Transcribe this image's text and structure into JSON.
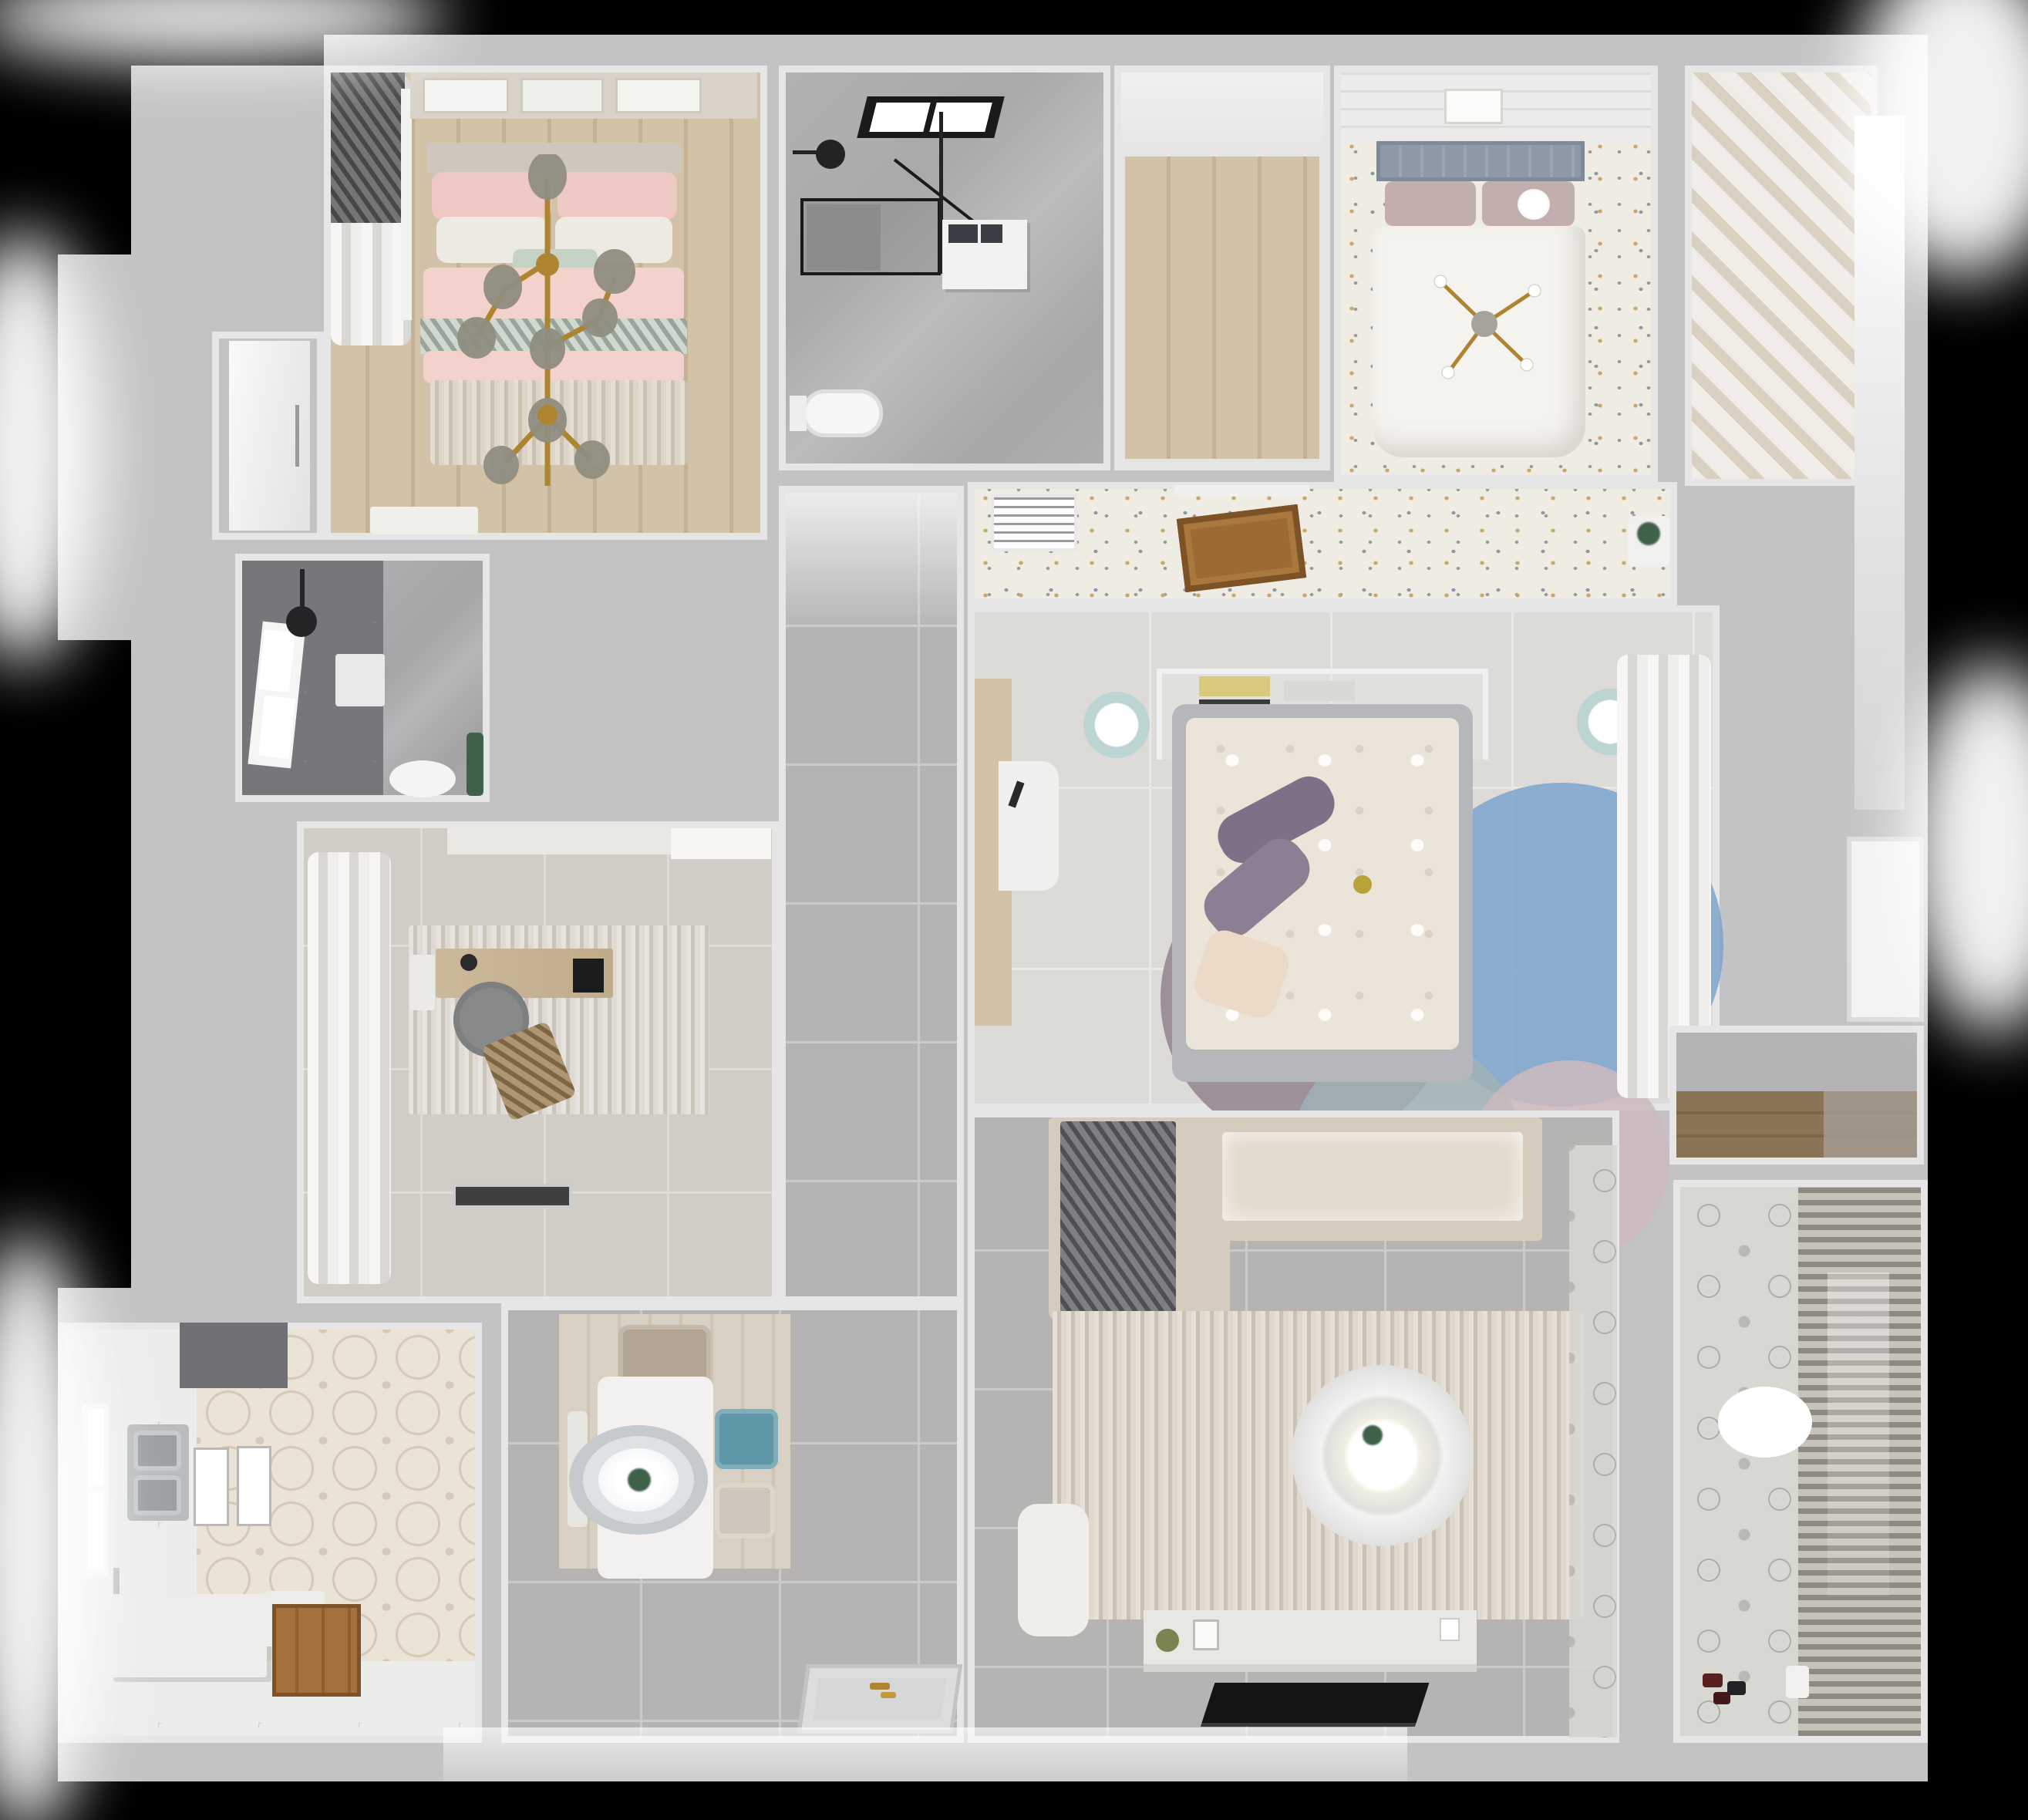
{
  "scene": {
    "type": "3d-floor-plan-top-down-render",
    "style": "photorealistic dollhouse view of an apartment",
    "background": "black with soft white light glows around the outer walls",
    "no_visible_text": true
  },
  "palette": {
    "bg": "#000000",
    "wall": "#c3c3c5",
    "wallface": "#e6e6e7",
    "tile": "#b5b4b2",
    "grout": "#cbcac8",
    "tile_light": "#d0cdc7",
    "grout_light": "#dfdcd6",
    "tile_large": "#dcdbd7",
    "grout_large": "#e9e8e4",
    "marble": "#adadaf",
    "dark_tile": "#75777a",
    "marble2": "#b6b8b9",
    "wood_a": "#d2c3a8",
    "wood_b": "#c5b294",
    "wood_door": "#9c6b33",
    "wood_dark": "#8a7456",
    "speckle_base": "#efece3",
    "speck1": "#c9a96a",
    "speck2": "#8a97a6",
    "speck3": "#9a9a94",
    "pink": "#f2d2cb",
    "pink_deep": "#eec8c3",
    "sage": "#c7d2c7",
    "white_soft": "#edeae4",
    "headboard_blue": "#8e99a8",
    "mauve": "#c3aeae",
    "duvet_white": "#f5f3ee",
    "cream": "#ebe5d9",
    "purple": "#7c7186",
    "bedframe": "#b5b7ba",
    "cream_pillow": "#ecd9c8",
    "rug_blue": "#7ba3cd",
    "rug_mauve": "#8f7d88",
    "rug_teal": "#9fb2b6",
    "rug_pink": "#cdb9bd",
    "rug_beige": "#d8cfc1",
    "sofa": "#d5ccbd",
    "cushion": "#e2dacb",
    "blanket": "#65676a",
    "table_white": "#f2f1ef",
    "teal": "#5e98a8",
    "chair_beige": "#b3a593",
    "chair_light": "#cfc6bb",
    "hex_base": "#eae3d6",
    "hex_line": "#d6c9b6",
    "white_tile": "#ececea",
    "steel": "#9aa0a3",
    "counter": "#ededeb",
    "dark_appliance": "#6f7174",
    "balc_tile": "#d8d8d3",
    "blind_a": "#8e8a82",
    "blind_b": "#c7c3bb",
    "gold": "#ad8530",
    "black": "#1a1a1c",
    "green": "#3f6049",
    "curtain_a": "#f7f6f4",
    "curtain_b": "#d9d8d5",
    "slat_a": "#f0ede8",
    "slat_b": "#d9d0c1",
    "console": "#e9e7e3",
    "glassdark": "#8a8c8e",
    "lounge_brown": "#a08257"
  },
  "rooms": [
    {
      "name": "master bedroom",
      "floor": "light wood planks",
      "furniture": [
        "double bed with pink duvet and sage throw",
        "pink and white pillows",
        "gold branch chandelier",
        "three wall art frames",
        "roman-blind window with curtains",
        "beige rug",
        "white vanity desk"
      ]
    },
    {
      "name": "entry door niche",
      "furniture": [
        "white interior door with long handle"
      ]
    },
    {
      "name": "shower room",
      "floor": "dark gray tile and marble",
      "furniture": [
        "window",
        "black ceiling rain shower head",
        "white shower tray",
        "toilet",
        "green plant"
      ]
    },
    {
      "name": "study",
      "floor": "light gray tile",
      "furniture": [
        "sheer white curtains",
        "wall cabinet",
        "textured area rug",
        "wooden desk",
        "black laptop",
        "gray office chair",
        "brown lounge chair",
        "dark doormat"
      ]
    },
    {
      "name": "kitchen",
      "floor": "hexagon patterned tile and white tile",
      "furniture": [
        "dark range hood block",
        "window",
        "double stainless sink",
        "two glass light panels",
        "white L counter",
        "wood entry inset",
        "chrome faucet"
      ]
    },
    {
      "name": "dining area",
      "floor": "gray tile with light wood mat",
      "furniture": [
        "white rectangular dining table",
        "oval pendant lamp with plant centerpiece",
        "beige chair",
        "teal chair",
        "second beige chair",
        "white bench",
        "patterned entry doormat with gold keys"
      ]
    },
    {
      "name": "hallway",
      "floor": "gray tile"
    },
    {
      "name": "main bathroom",
      "floor": "gray marble",
      "furniture": [
        "black framed skylight",
        "black glass shower enclosure",
        "black rain shower head",
        "washing machine / vanity unit",
        "toilet"
      ]
    },
    {
      "name": "walk-in closet",
      "floor": "wood planks"
    },
    {
      "name": "guest bedroom",
      "floor": "speckled terrazzo-style",
      "furniture": [
        "bed with white duvet",
        "blue-gray slatted headboard",
        "mauve pillows",
        "white ball lamp",
        "gold four-arm chandelier",
        "art frame",
        "plank ceiling band"
      ]
    },
    {
      "name": "wardrobe cabinet",
      "furniture": [
        "slatted sliding-door wardrobe"
      ]
    },
    {
      "name": "vestibule",
      "floor": "speckled terrazzo-style",
      "furniture": [
        "white AC vent grille",
        "open brown wood door",
        "plant stand"
      ]
    },
    {
      "name": "kids bedroom",
      "floor": "large light tile",
      "furniture": [
        "bed with cream floral duvet",
        "purple pillows",
        "white headboard shelf with books",
        "two teal poufs",
        "white desk",
        "wood wardrobe strip",
        "overlapping circle rug in blue mauve teal pink",
        "sheer curtains"
      ]
    },
    {
      "name": "living room",
      "floor": "gray tile",
      "furniture": [
        "L-shaped beige sofa",
        "dark gray throw blanket",
        "large beige rug",
        "round white coffee table with plant",
        "white armchair",
        "white TV console with decor",
        "black flat TV",
        "patterned tile strip"
      ]
    },
    {
      "name": "balcony",
      "floor": "patterned cement tile",
      "furniture": [
        "venetian blinds window wall",
        "white ceiling lamp",
        "toy cars",
        "white watering can"
      ]
    },
    {
      "name": "storage niche",
      "furniture": [
        "wood cabinet band"
      ]
    }
  ]
}
